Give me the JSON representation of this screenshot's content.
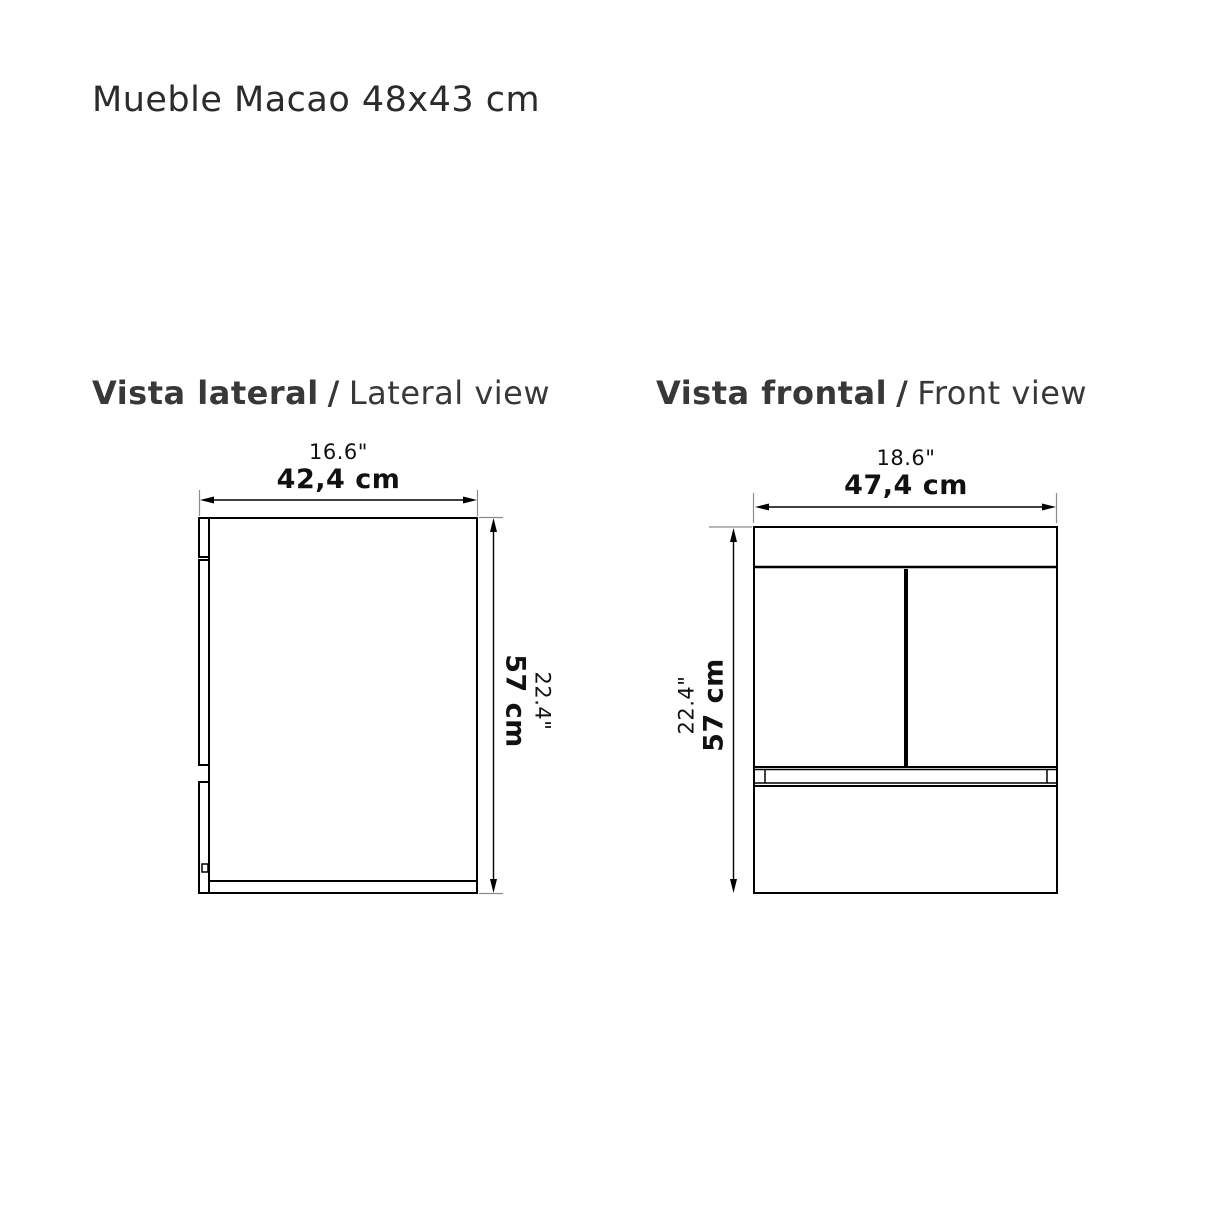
{
  "page": {
    "title": "Mueble Macao 48x43 cm"
  },
  "views": {
    "lateral": {
      "heading": {
        "es": "Vista lateral",
        "sep": "/",
        "en": "Lateral view"
      },
      "width_dim": {
        "inches": "16.6\"",
        "cm": "42,4 cm"
      },
      "height_dim": {
        "inches": "22.4\"",
        "cm": "57 cm"
      }
    },
    "frontal": {
      "heading": {
        "es": "Vista frontal",
        "sep": "/",
        "en": "Front view"
      },
      "width_dim": {
        "inches": "18.6\"",
        "cm": "47,4 cm"
      },
      "height_dim": {
        "inches": "22.4\"",
        "cm": "57 cm"
      }
    }
  },
  "colors": {
    "line": "#000000",
    "extension": "#8c8c8c",
    "text": "#111111",
    "heading": "#383838",
    "background": "#ffffff"
  }
}
